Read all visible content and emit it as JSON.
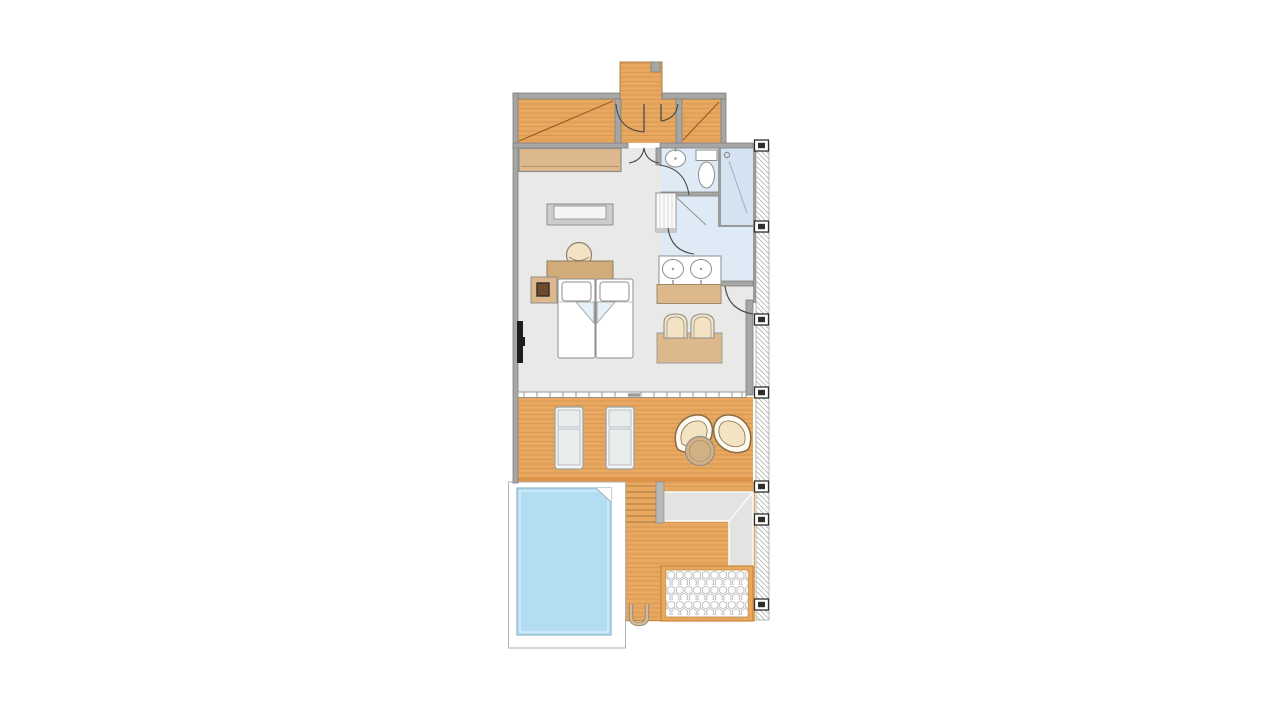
{
  "colors": {
    "background": "#ffffff",
    "wall": "#a6a6a4",
    "wall_edge": "#7f7f7d",
    "outline": "#8e8e8c",
    "floor_bedroom": "#e9e9e7",
    "floor_bathroom": "#deebf6",
    "floor_shower": "#d3e3f1",
    "deck": "#e9a860",
    "deck_edge": "#c8873c",
    "deck_band": "#dd9448",
    "deck_plank": "#b06f2e",
    "entry_diagonal": "#a05a2a",
    "wood": "#dcb88c",
    "wood_dark": "#d2ab7a",
    "pool": "#b2ddf2",
    "pool_edge": "#8fb5c9",
    "pool_deck": "#ffffff",
    "walkway": "#e3e3e1",
    "cream": "#f3e3c3",
    "chair_outline": "#8a6b42",
    "lounger": "#e9eded",
    "fold": "#e6f1f7",
    "tile_stroke": "#a8a8a6",
    "marker": "#2e2e2c",
    "tv": "#1e1e1c",
    "table_round": "#d2b186"
  },
  "features": [
    "entry-walkway",
    "entry-hall",
    "entry-door",
    "wardrobe",
    "bedroom",
    "double-bed",
    "nightstand",
    "wall-tv",
    "sofa-bench",
    "desk",
    "desk-chair",
    "dining-table",
    "dining-chairs",
    "bathroom",
    "washbasin",
    "toilet",
    "shower",
    "walk-in-closet",
    "double-vanity",
    "sliding-glass-door",
    "terrace",
    "sun-loungers",
    "lounge-chairs",
    "side-table",
    "steps",
    "walkway-path",
    "honeycomb-patio",
    "plunge-pool",
    "pool-ladder",
    "boundary-fence"
  ]
}
